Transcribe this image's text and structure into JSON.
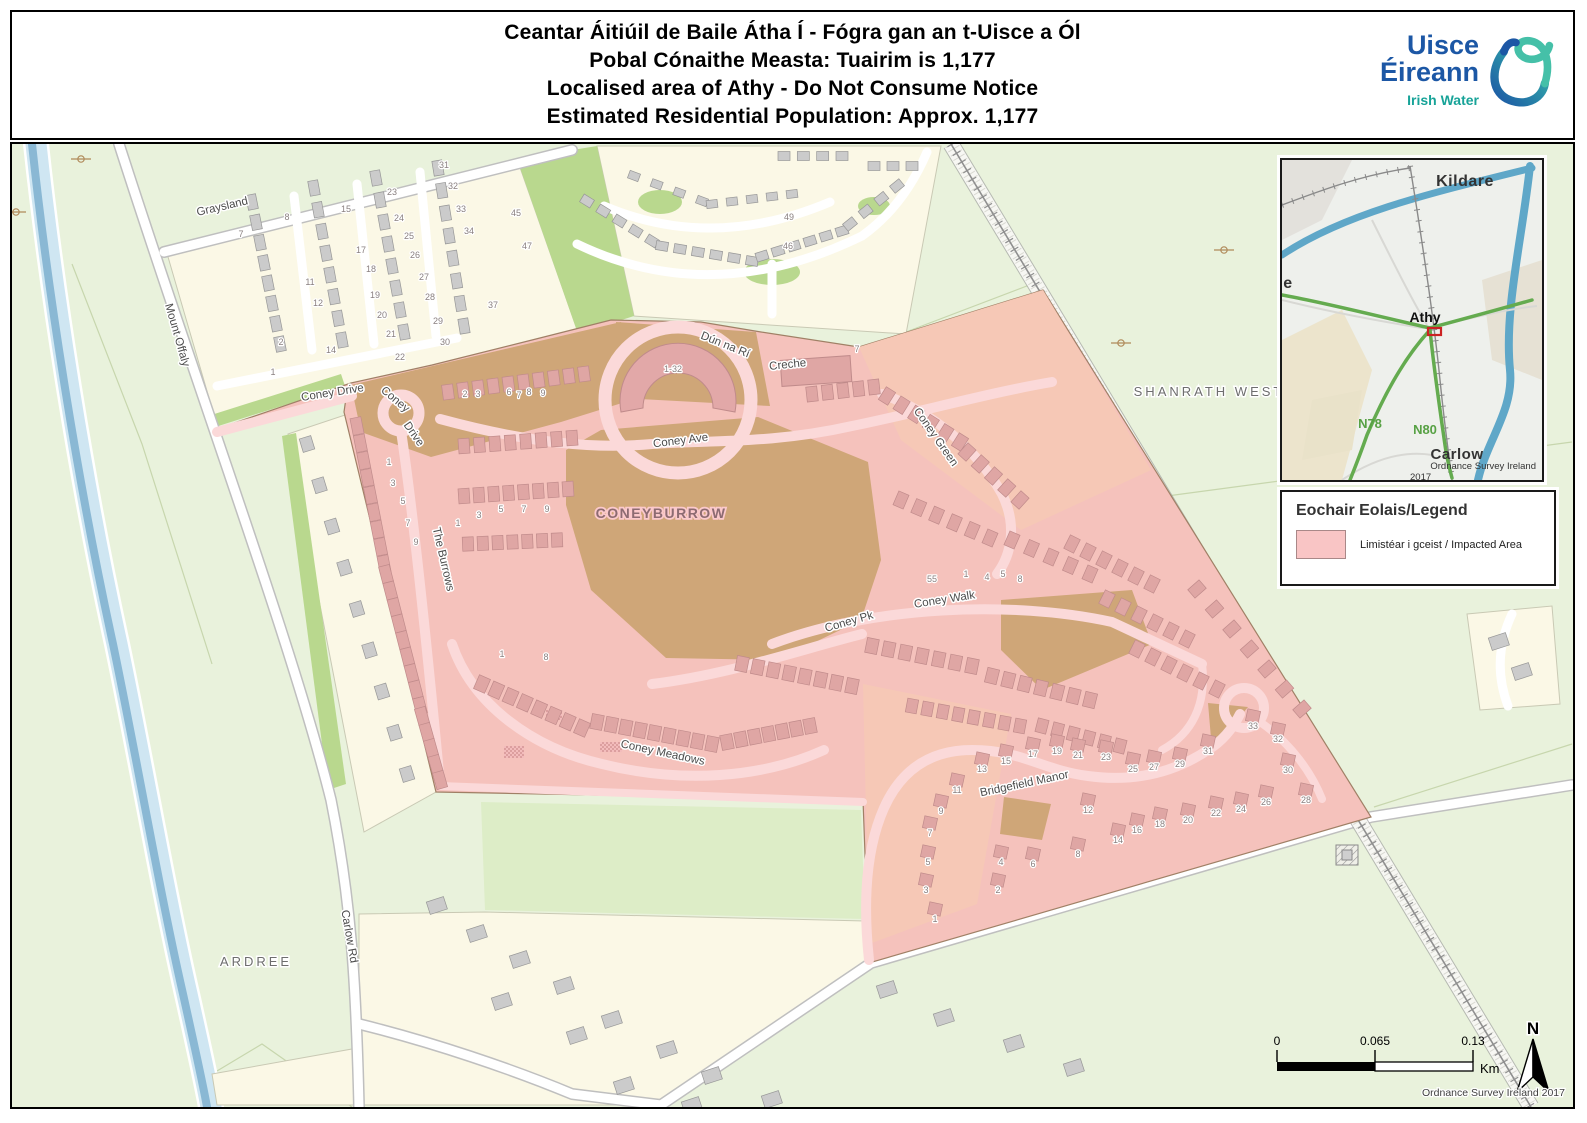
{
  "header": {
    "title_lines": [
      "Ceantar Áitiúil de Baile Átha Í - Fógra gan an t-Uisce a Ól",
      "Pobal Cónaithe Measta: Tuairim is 1,177",
      "Localised area of Athy - Do Not Consume Notice",
      "Estimated Residential Population: Approx. 1,177"
    ],
    "logo": {
      "line1": "Uisce",
      "line2": "Éireann",
      "subtitle": "Irish Water"
    }
  },
  "map": {
    "area_labels": [
      {
        "text": "SHANRATH WEST",
        "x": 1197,
        "y": 252,
        "cls": "area"
      },
      {
        "text": "ARDREE",
        "x": 244,
        "y": 822,
        "cls": "area"
      },
      {
        "text": "CONEYBURROW",
        "x": 649,
        "y": 374,
        "cls": "estate"
      }
    ],
    "street_labels": [
      {
        "text": "Graysland",
        "x": 211,
        "y": 66,
        "r": -13
      },
      {
        "text": "Mount Offaly",
        "x": 162,
        "y": 192,
        "r": 74
      },
      {
        "text": "Carlow Rd",
        "x": 334,
        "y": 793,
        "r": 80
      },
      {
        "text": "Coney Drive",
        "x": 321,
        "y": 252,
        "r": -9
      },
      {
        "text": "Coney",
        "x": 381,
        "y": 258,
        "r": 40
      },
      {
        "text": "Drive",
        "x": 399,
        "y": 292,
        "r": 55
      },
      {
        "text": "Coney Ave",
        "x": 669,
        "y": 300,
        "r": -7
      },
      {
        "text": "Dún na Rí",
        "x": 712,
        "y": 204,
        "r": 22
      },
      {
        "text": "Creche",
        "x": 776,
        "y": 224,
        "r": -6
      },
      {
        "text": "Coney Green",
        "x": 921,
        "y": 295,
        "r": 55
      },
      {
        "text": "The Burrows",
        "x": 428,
        "y": 416,
        "r": 77
      },
      {
        "text": "Coney Walk",
        "x": 933,
        "y": 459,
        "r": -9
      },
      {
        "text": "Coney Pk",
        "x": 838,
        "y": 481,
        "r": -16
      },
      {
        "text": "Coney Meadows",
        "x": 650,
        "y": 612,
        "r": 12
      },
      {
        "text": "Bridgefield Manor",
        "x": 1013,
        "y": 643,
        "r": -12
      }
    ],
    "house_numbers": [
      {
        "t": "7",
        "x": 229,
        "y": 93
      },
      {
        "t": "8",
        "x": 275,
        "y": 76
      },
      {
        "t": "15",
        "x": 334,
        "y": 68
      },
      {
        "t": "23",
        "x": 380,
        "y": 51
      },
      {
        "t": "24",
        "x": 387,
        "y": 77
      },
      {
        "t": "25",
        "x": 397,
        "y": 95
      },
      {
        "t": "26",
        "x": 403,
        "y": 114
      },
      {
        "t": "27",
        "x": 412,
        "y": 136
      },
      {
        "t": "28",
        "x": 418,
        "y": 156
      },
      {
        "t": "29",
        "x": 426,
        "y": 180
      },
      {
        "t": "30",
        "x": 433,
        "y": 201
      },
      {
        "t": "17",
        "x": 349,
        "y": 109
      },
      {
        "t": "18",
        "x": 359,
        "y": 128
      },
      {
        "t": "19",
        "x": 363,
        "y": 154
      },
      {
        "t": "20",
        "x": 370,
        "y": 174
      },
      {
        "t": "21",
        "x": 379,
        "y": 193
      },
      {
        "t": "22",
        "x": 388,
        "y": 216
      },
      {
        "t": "11",
        "x": 298,
        "y": 141
      },
      {
        "t": "12",
        "x": 306,
        "y": 162
      },
      {
        "t": "14",
        "x": 319,
        "y": 209
      },
      {
        "t": "2",
        "x": 269,
        "y": 201
      },
      {
        "t": "1",
        "x": 261,
        "y": 231
      },
      {
        "t": "31",
        "x": 432,
        "y": 24
      },
      {
        "t": "32",
        "x": 441,
        "y": 45
      },
      {
        "t": "33",
        "x": 449,
        "y": 68
      },
      {
        "t": "34",
        "x": 457,
        "y": 90
      },
      {
        "t": "45",
        "x": 504,
        "y": 72
      },
      {
        "t": "47",
        "x": 515,
        "y": 105
      },
      {
        "t": "37",
        "x": 481,
        "y": 164
      },
      {
        "t": "49",
        "x": 777,
        "y": 76
      },
      {
        "t": "46",
        "x": 776,
        "y": 105
      },
      {
        "t": "1-32",
        "x": 661,
        "y": 228
      },
      {
        "t": "2",
        "x": 453,
        "y": 253
      },
      {
        "t": "3",
        "x": 466,
        "y": 253
      },
      {
        "t": "6",
        "x": 497,
        "y": 251
      },
      {
        "t": "7",
        "x": 507,
        "y": 254
      },
      {
        "t": "8",
        "x": 517,
        "y": 251
      },
      {
        "t": "9",
        "x": 531,
        "y": 252
      },
      {
        "t": "1",
        "x": 377,
        "y": 321
      },
      {
        "t": "3",
        "x": 381,
        "y": 342
      },
      {
        "t": "5",
        "x": 391,
        "y": 360
      },
      {
        "t": "7",
        "x": 396,
        "y": 382
      },
      {
        "t": "9",
        "x": 404,
        "y": 401
      },
      {
        "t": "1",
        "x": 446,
        "y": 382
      },
      {
        "t": "3",
        "x": 467,
        "y": 374
      },
      {
        "t": "5",
        "x": 489,
        "y": 368
      },
      {
        "t": "7",
        "x": 512,
        "y": 368
      },
      {
        "t": "9",
        "x": 535,
        "y": 368
      },
      {
        "t": "1",
        "x": 490,
        "y": 513
      },
      {
        "t": "8",
        "x": 534,
        "y": 516
      },
      {
        "t": "7",
        "x": 845,
        "y": 208
      },
      {
        "t": "55",
        "x": 920,
        "y": 438
      },
      {
        "t": "1",
        "x": 954,
        "y": 433
      },
      {
        "t": "4",
        "x": 975,
        "y": 436
      },
      {
        "t": "5",
        "x": 991,
        "y": 433
      },
      {
        "t": "8",
        "x": 1008,
        "y": 438
      },
      {
        "t": "11",
        "x": 945,
        "y": 649
      },
      {
        "t": "9",
        "x": 929,
        "y": 670
      },
      {
        "t": "7",
        "x": 918,
        "y": 692
      },
      {
        "t": "5",
        "x": 916,
        "y": 721
      },
      {
        "t": "3",
        "x": 914,
        "y": 749
      },
      {
        "t": "1",
        "x": 923,
        "y": 778
      },
      {
        "t": "2",
        "x": 986,
        "y": 749
      },
      {
        "t": "4",
        "x": 989,
        "y": 721
      },
      {
        "t": "6",
        "x": 1021,
        "y": 723
      },
      {
        "t": "8",
        "x": 1066,
        "y": 713
      },
      {
        "t": "12",
        "x": 1076,
        "y": 669
      },
      {
        "t": "13",
        "x": 970,
        "y": 628
      },
      {
        "t": "15",
        "x": 994,
        "y": 620
      },
      {
        "t": "17",
        "x": 1021,
        "y": 613
      },
      {
        "t": "19",
        "x": 1045,
        "y": 610
      },
      {
        "t": "21",
        "x": 1066,
        "y": 614
      },
      {
        "t": "23",
        "x": 1094,
        "y": 616
      },
      {
        "t": "25",
        "x": 1121,
        "y": 628
      },
      {
        "t": "27",
        "x": 1142,
        "y": 626
      },
      {
        "t": "29",
        "x": 1168,
        "y": 623
      },
      {
        "t": "31",
        "x": 1196,
        "y": 610
      },
      {
        "t": "33",
        "x": 1241,
        "y": 585
      },
      {
        "t": "32",
        "x": 1266,
        "y": 598
      },
      {
        "t": "30",
        "x": 1276,
        "y": 629
      },
      {
        "t": "28",
        "x": 1294,
        "y": 659
      },
      {
        "t": "26",
        "x": 1254,
        "y": 661
      },
      {
        "t": "24",
        "x": 1229,
        "y": 668
      },
      {
        "t": "22",
        "x": 1204,
        "y": 672
      },
      {
        "t": "20",
        "x": 1176,
        "y": 679
      },
      {
        "t": "18",
        "x": 1148,
        "y": 683
      },
      {
        "t": "16",
        "x": 1125,
        "y": 689
      },
      {
        "t": "14",
        "x": 1106,
        "y": 699
      }
    ],
    "attribution": "Ordnance Survey Ireland 2017"
  },
  "inset": {
    "labels": [
      {
        "text": "Kildare",
        "x": 183,
        "y": 26,
        "cls": "ins-place"
      },
      {
        "text": "e",
        "x": 6,
        "y": 128,
        "cls": "ins-place"
      },
      {
        "text": "Athy",
        "x": 143,
        "y": 162,
        "cls": "ins-town"
      },
      {
        "text": "N78",
        "x": 88,
        "y": 268,
        "cls": "ins-road"
      },
      {
        "text": "N80",
        "x": 143,
        "y": 274,
        "cls": "ins-road"
      },
      {
        "text": "Carlow",
        "x": 175,
        "y": 299,
        "cls": "ins-place2"
      },
      {
        "text": "Ordnance Survey Ireland",
        "x": 254,
        "y": 309,
        "cls": "ins-small-end"
      },
      {
        "text": "2017",
        "x": 128,
        "y": 320,
        "cls": "ins-small"
      }
    ]
  },
  "legend": {
    "title": "Eochair Eolais/Legend",
    "items": [
      {
        "label": "Limistéar i gceist / Impacted Area",
        "color": "#f9c5c5"
      }
    ]
  },
  "scalebar": {
    "ticks": [
      "0",
      "0.065",
      "0.13"
    ],
    "unit": "Km"
  },
  "north": {
    "label": "N"
  },
  "colors": {
    "impacted": "#f9c5c5",
    "impacted_area_fill": "#f5c2bc",
    "impacted_field_fill": "#f6c8b6",
    "open_space_tan": "#cfa678",
    "water": "#8ab8d4",
    "logo_blue": "#1c57a5",
    "logo_teal": "#17a398",
    "inset_road_green": "#64ab4f"
  }
}
